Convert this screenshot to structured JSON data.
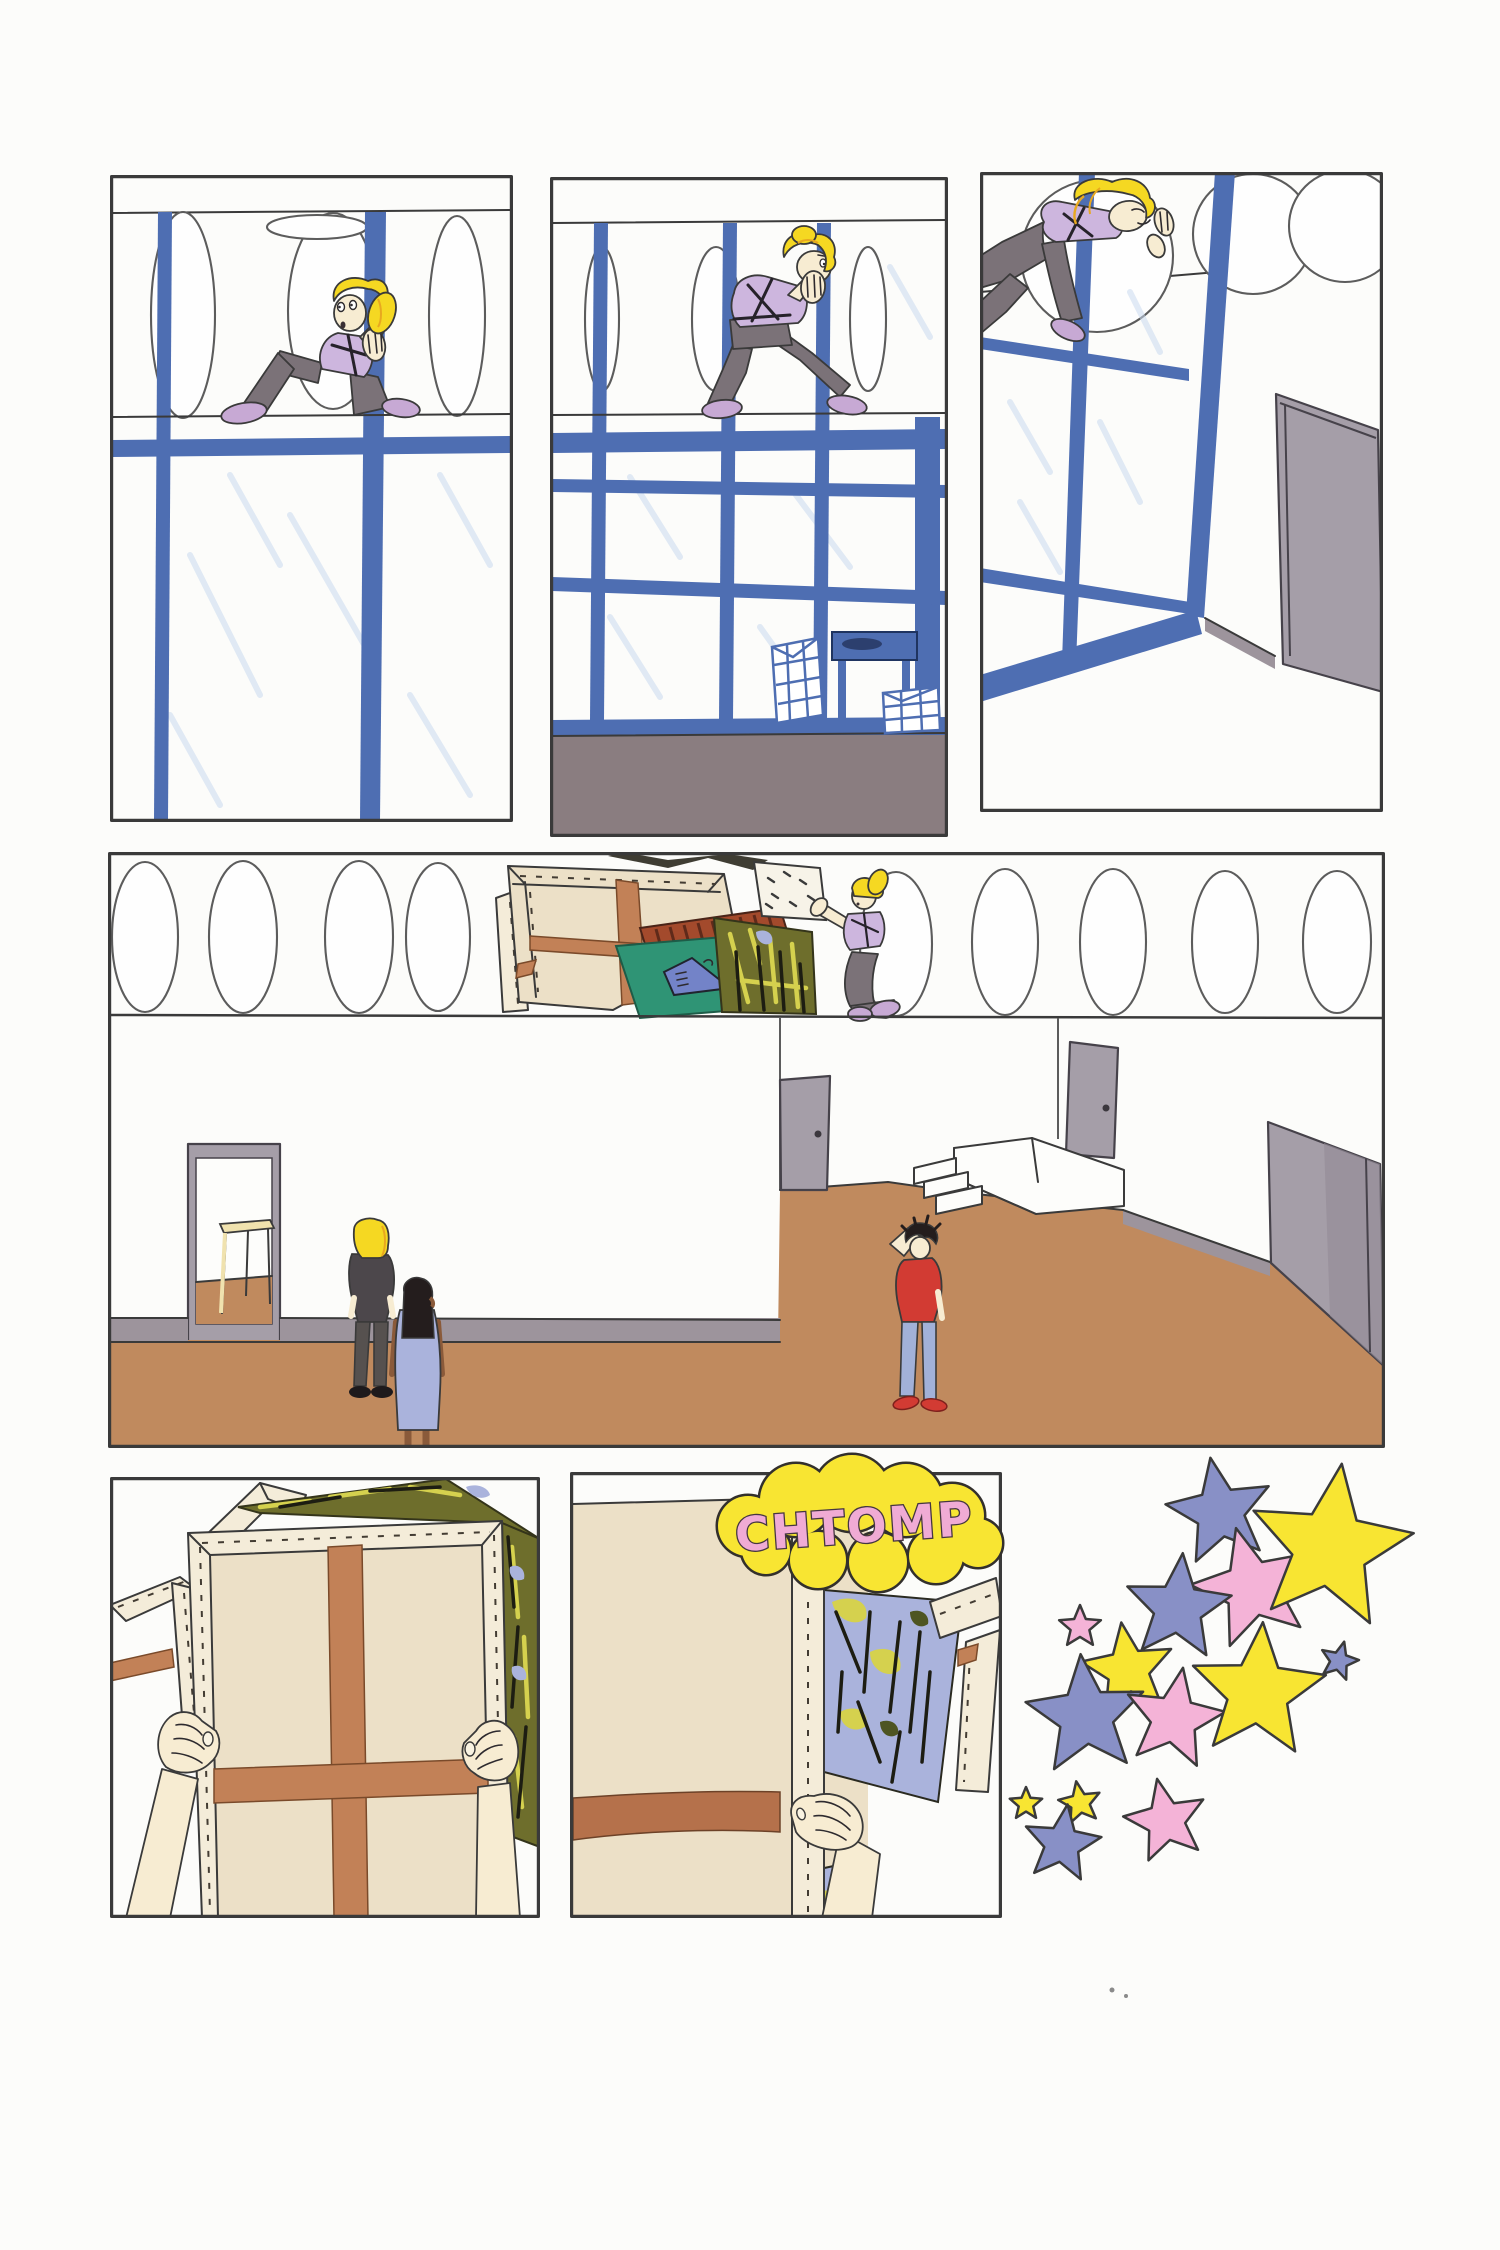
{
  "page": {
    "type": "comic-page",
    "background": "#fcfcfa"
  },
  "sfx": {
    "text": "CHTOMP"
  },
  "palette": {
    "paper": "#fcfcfa",
    "line": "#3a3a3a",
    "blue": "#4e6eb2",
    "glass": "#c9d9ee",
    "mauveFloor": "#8a7d80",
    "tanFloor": "#c08a5e",
    "baseboard": "#9d949c",
    "doorGray": "#a59ea8",
    "doorGrayDark": "#948c96",
    "cream": "#ece0c7",
    "creamBar": "#f4ecd9",
    "brace": "#c28157",
    "braceDark": "#b5714b",
    "skin": "#f7ecd2",
    "skinDark": "#8a5a3a",
    "hair": "#f5d822",
    "hairShade": "#e8a81f",
    "lavender": "#cdb6de",
    "pantsGray": "#7b7278",
    "shoePurple": "#c7a9d4",
    "teal": "#2f9475",
    "tent": "#7383c8",
    "slatRed": "#a34a2c",
    "olive": "#6e6e2c",
    "oliveBright": "#d5d14e",
    "periwinkle": "#aab3dc",
    "redShirt": "#d23b33",
    "jeans": "#a2b1d8",
    "charcoal": "#4c474b",
    "tableCream": "#f0e2ae",
    "bubbleYellow": "#f8e532",
    "sfxPink": "#f0abd4",
    "starYellow": "#f8e532",
    "starBlue": "#8890c6",
    "starPink": "#f4b3d7"
  },
  "stars": [
    {
      "color": "starBlue",
      "x": 1220,
      "y": 1512,
      "r": 55,
      "rot": -10
    },
    {
      "color": "starPink",
      "x": 1252,
      "y": 1588,
      "r": 62,
      "rot": -15
    },
    {
      "color": "starBlue",
      "x": 1178,
      "y": 1608,
      "r": 55,
      "rot": 5
    },
    {
      "color": "starYellow",
      "x": 1330,
      "y": 1548,
      "r": 85,
      "rot": 8
    },
    {
      "color": "starYellow",
      "x": 1128,
      "y": 1670,
      "r": 48,
      "rot": -8
    },
    {
      "color": "starBlue",
      "x": 1086,
      "y": 1716,
      "r": 62,
      "rot": -5
    },
    {
      "color": "starPink",
      "x": 1174,
      "y": 1719,
      "r": 52,
      "rot": 10
    },
    {
      "color": "starYellow",
      "x": 1258,
      "y": 1692,
      "r": 70,
      "rot": 4
    },
    {
      "color": "starBlue",
      "x": 1339,
      "y": 1661,
      "r": 20,
      "rot": 15
    },
    {
      "color": "starPink",
      "x": 1080,
      "y": 1627,
      "r": 22,
      "rot": 0
    },
    {
      "color": "starYellow",
      "x": 1026,
      "y": 1804,
      "r": 17,
      "rot": 0
    },
    {
      "color": "starYellow",
      "x": 1080,
      "y": 1803,
      "r": 22,
      "rot": -10
    },
    {
      "color": "starBlue",
      "x": 1062,
      "y": 1844,
      "r": 40,
      "rot": 8
    },
    {
      "color": "starPink",
      "x": 1166,
      "y": 1821,
      "r": 43,
      "rot": -12
    }
  ],
  "speckles": [
    {
      "x": 1112,
      "y": 1990,
      "r": 2.5
    },
    {
      "x": 1126,
      "y": 1996,
      "r": 2
    }
  ]
}
